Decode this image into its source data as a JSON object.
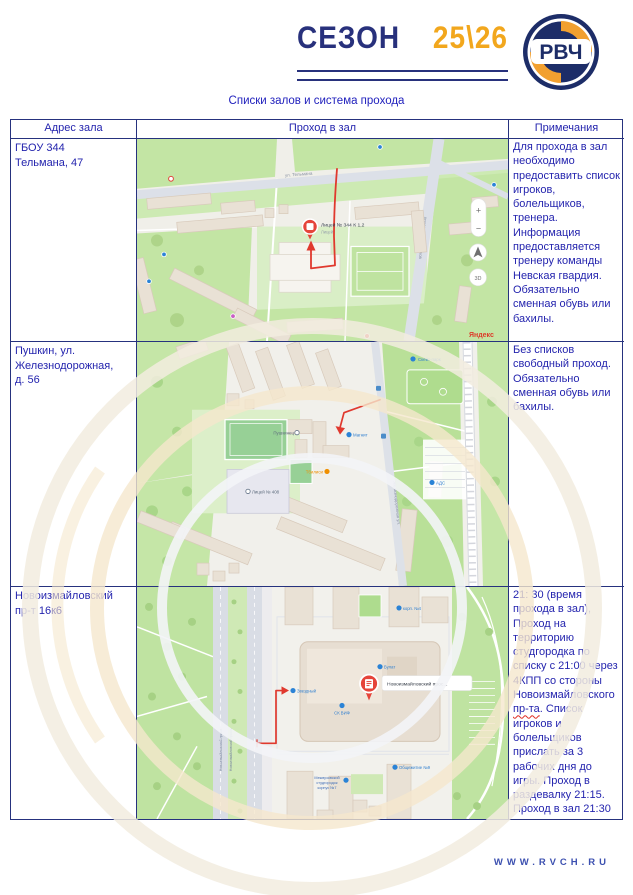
{
  "header": {
    "season": "СЕЗОН",
    "years": "25\\26",
    "logo": "РВЧ",
    "subtitle": "Списки залов и система прохода"
  },
  "table": {
    "headers": [
      "Адрес зала",
      "Проход в зал",
      "Примечания"
    ],
    "rows": [
      {
        "address": "ГБОУ 344\nТельмана, 47",
        "notes": "Для прохода в зал необходимо предоставить список игроков, болельщиков, тренера. Информация предоставляется тренеру команды Невская гвардия. Обязательно сменная обувь или бахилы."
      },
      {
        "address": "Пушкин, ул.\nЖелезнодорожная,\nд. 56",
        "notes": "Без списков свободный проход. Обязательно сменная обувь или бахилы."
      },
      {
        "address": "Новоизмайловский\nпр-т 16к6",
        "notes_pre": "21: 30 (время прохода в зал), Проход на территорию студгородка по списку с 21:00 через 4КПП со стороны Новоизмайловского ",
        "notes_word": "пр-та",
        "notes_post": ". Список игроков и болельщиков прислать за 3 рабочих дня до игры. Проход в раздевалку 21:15. Проход в зал 21:30"
      }
    ]
  },
  "maps": {
    "map1": {
      "pin_label": "Лицей № 344 К 1,2",
      "pin_sublabel": "Лицей",
      "road_top": "ул. Тельмана",
      "road_right": "просп. Большевиков",
      "zoom_in": "+",
      "zoom_out": "−",
      "rotate": "3D",
      "yandex": "Яндекс"
    },
    "map2": {
      "skatepark": "Скейт-парк",
      "hall": "Пушкинец",
      "magnit": "Магнит",
      "tbilisi": "Тбилиси",
      "school": "Лицей № 408",
      "ads": "АДС",
      "road": "Железнодорожная ул."
    },
    "map3": {
      "road1": "Новоизмайловский просп.",
      "road2": "Новоизмайловский просп.",
      "pin_label": "Новоизмайловский прос...",
      "zvezdny": "Звездный",
      "sk_vif": "СК ВИФ",
      "bulat": "Булат",
      "korp4": "корп. №4",
      "dorm": "Общежитие №9",
      "campus_l1": "Межвузовский",
      "campus_l2": "студгородок",
      "campus_l3": "корпус №7"
    }
  },
  "footer": {
    "site": "WWW.RVCH.RU"
  },
  "colors": {
    "navy": "#26327e",
    "gold": "#f2a71d",
    "accent_red": "#e0392e",
    "text_blue": "#2424ae"
  }
}
